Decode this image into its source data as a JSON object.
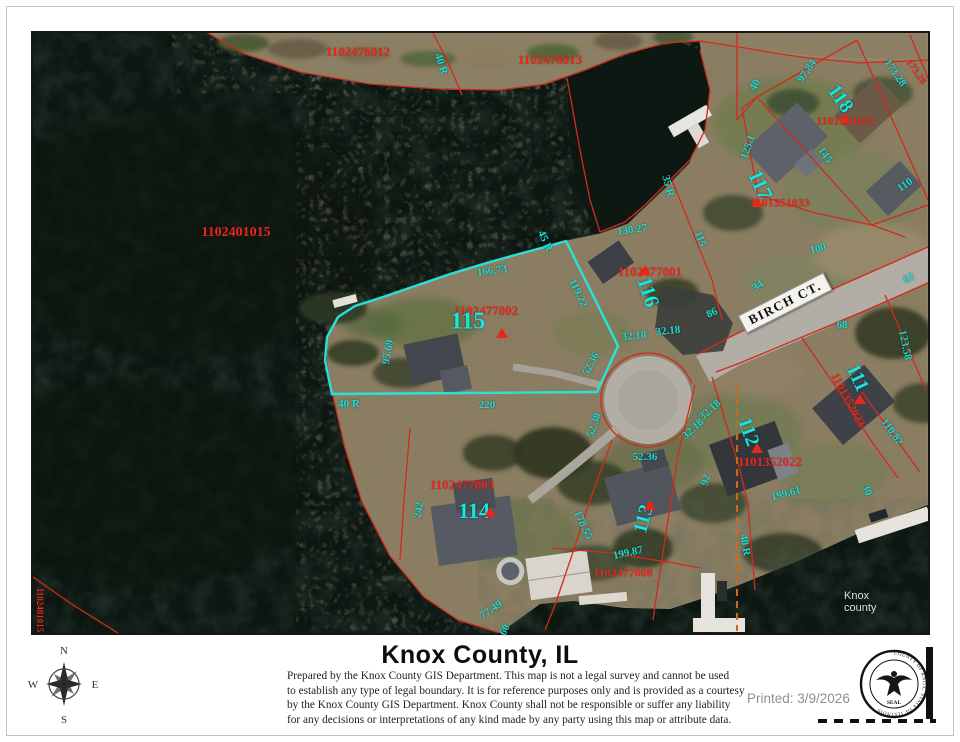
{
  "map": {
    "street_sign": "BIRCH CT.",
    "watermark": "Knox county",
    "red_labels": [
      {
        "t": "1102476012",
        "x": 325,
        "y": 19,
        "r": 0,
        "s": 13
      },
      {
        "t": "1102476013",
        "x": 517,
        "y": 27,
        "r": 0,
        "s": 13
      },
      {
        "t": "1102401015",
        "x": 203,
        "y": 200,
        "r": 0,
        "s": 14
      },
      {
        "t": "1102477002",
        "x": 453,
        "y": 278,
        "r": 0,
        "s": 13
      },
      {
        "t": "1102477001",
        "x": 617,
        "y": 239,
        "r": 0,
        "s": 13
      },
      {
        "t": "1101351031",
        "x": 813,
        "y": 88,
        "r": 0,
        "s": 12
      },
      {
        "t": "1101351033",
        "x": 747,
        "y": 170,
        "r": 0,
        "s": 12
      },
      {
        "t": "1101352022",
        "x": 737,
        "y": 429,
        "r": 0,
        "s": 13
      },
      {
        "t": "1101352023",
        "x": 815,
        "y": 367,
        "r": 62,
        "s": 12
      },
      {
        "t": "1102477003",
        "x": 429,
        "y": 452,
        "r": 0,
        "s": 13
      },
      {
        "t": "1102477008",
        "x": 590,
        "y": 540,
        "r": 0,
        "s": 12
      },
      {
        "t": "1102401015",
        "x": 7,
        "y": 577,
        "r": 90,
        "s": 9
      },
      {
        "t": "173.28",
        "x": 883,
        "y": 39,
        "r": 55,
        "s": 10
      }
    ],
    "lot_numbers": [
      {
        "t": "115",
        "x": 435,
        "y": 289,
        "r": 0,
        "s": 24
      },
      {
        "t": "116",
        "x": 615,
        "y": 259,
        "r": 72,
        "s": 21
      },
      {
        "t": "117",
        "x": 727,
        "y": 152,
        "r": 65,
        "s": 21
      },
      {
        "t": "118",
        "x": 807,
        "y": 66,
        "r": 55,
        "s": 20
      },
      {
        "t": "111",
        "x": 824,
        "y": 345,
        "r": 65,
        "s": 20
      },
      {
        "t": "112",
        "x": 715,
        "y": 399,
        "r": 70,
        "s": 20
      },
      {
        "t": "113",
        "x": 611,
        "y": 486,
        "r": -75,
        "s": 20
      },
      {
        "t": "114",
        "x": 441,
        "y": 478,
        "r": 0,
        "s": 22
      }
    ],
    "dimensions": [
      {
        "t": "40 R",
        "x": 408,
        "y": 31,
        "r": 72
      },
      {
        "t": "35 R",
        "x": 635,
        "y": 153,
        "r": 75
      },
      {
        "t": "45 R",
        "x": 512,
        "y": 208,
        "r": 65
      },
      {
        "t": "166.73",
        "x": 459,
        "y": 238,
        "r": -8
      },
      {
        "t": "119.22",
        "x": 545,
        "y": 260,
        "r": 65
      },
      {
        "t": "130.27",
        "x": 599,
        "y": 197,
        "r": -8
      },
      {
        "t": "115",
        "x": 667,
        "y": 206,
        "r": 68
      },
      {
        "t": "95.69",
        "x": 355,
        "y": 319,
        "r": -80
      },
      {
        "t": "40 R",
        "x": 316,
        "y": 371,
        "r": 0
      },
      {
        "t": "220",
        "x": 454,
        "y": 372,
        "r": 0
      },
      {
        "t": "32.18",
        "x": 601,
        "y": 303,
        "r": -6
      },
      {
        "t": "32.18",
        "x": 635,
        "y": 298,
        "r": -6
      },
      {
        "t": "52.36",
        "x": 558,
        "y": 331,
        "r": -62
      },
      {
        "t": "52.38",
        "x": 561,
        "y": 392,
        "r": -72
      },
      {
        "t": "52.36",
        "x": 612,
        "y": 424,
        "r": 0
      },
      {
        "t": "86",
        "x": 679,
        "y": 280,
        "r": -25
      },
      {
        "t": "68",
        "x": 809,
        "y": 292,
        "r": 0
      },
      {
        "t": "34",
        "x": 725,
        "y": 253,
        "r": -35
      },
      {
        "t": "100",
        "x": 785,
        "y": 216,
        "r": -15
      },
      {
        "t": "62",
        "x": 876,
        "y": 245,
        "r": -30
      },
      {
        "t": "123.58",
        "x": 872,
        "y": 312,
        "r": 78
      },
      {
        "t": "110.82",
        "x": 859,
        "y": 399,
        "r": 55
      },
      {
        "t": "173.28",
        "x": 862,
        "y": 40,
        "r": 55
      },
      {
        "t": "97.84",
        "x": 774,
        "y": 38,
        "r": -55
      },
      {
        "t": "40",
        "x": 722,
        "y": 52,
        "r": -60
      },
      {
        "t": "125.1",
        "x": 715,
        "y": 114,
        "r": -70
      },
      {
        "t": "145",
        "x": 792,
        "y": 122,
        "r": 55
      },
      {
        "t": "110",
        "x": 872,
        "y": 152,
        "r": -35
      },
      {
        "t": "242",
        "x": 386,
        "y": 477,
        "r": -80
      },
      {
        "t": "178.55",
        "x": 550,
        "y": 492,
        "r": 65
      },
      {
        "t": "199.87",
        "x": 595,
        "y": 520,
        "r": -12
      },
      {
        "t": "199.61",
        "x": 753,
        "y": 461,
        "r": -15
      },
      {
        "t": "92",
        "x": 673,
        "y": 447,
        "r": -75
      },
      {
        "t": "40 R",
        "x": 712,
        "y": 512,
        "r": 80
      },
      {
        "t": "30",
        "x": 834,
        "y": 457,
        "r": 70
      },
      {
        "t": "60",
        "x": 472,
        "y": 597,
        "r": -65
      },
      {
        "t": "77.49",
        "x": 458,
        "y": 577,
        "r": -35
      },
      {
        "t": "32.18",
        "x": 677,
        "y": 377,
        "r": -42
      },
      {
        "t": "32.18",
        "x": 660,
        "y": 396,
        "r": -42
      }
    ],
    "triangles": [
      {
        "x": 469,
        "y": 300
      },
      {
        "x": 612,
        "y": 237
      },
      {
        "x": 812,
        "y": 85
      },
      {
        "x": 724,
        "y": 169
      },
      {
        "x": 827,
        "y": 366
      },
      {
        "x": 724,
        "y": 415
      },
      {
        "x": 617,
        "y": 472
      },
      {
        "x": 457,
        "y": 479
      }
    ]
  },
  "footer": {
    "title": "Knox County, IL",
    "disclaimer_lines": [
      "Prepared by the Knox County GIS Department. This map is not a legal survey and cannot be used",
      "to establish any type of legal boundary. It is for reference purposes only and is provided as a courtesy",
      "by the Knox County GIS Department.  Knox County shall not be responsible or suffer any liability",
      "for any decisions or interpretations of any kind made by any party using this map or attribute data."
    ],
    "printed_label": "Printed: 3/9/2026",
    "compass": {
      "n": "N",
      "s": "S",
      "e": "E",
      "w": "W"
    },
    "seal_ring": "COUNTY OF KNOX, STATE OF ILLINOIS",
    "seal_label": "SEAL"
  },
  "colors": {
    "parcel_line": "#d22a1c",
    "highlight": "#25e8e2",
    "label_red": "#e5281c",
    "label_cyan": "#17ddd6",
    "water": "#0d1712",
    "section_line": "#c96a1f"
  }
}
